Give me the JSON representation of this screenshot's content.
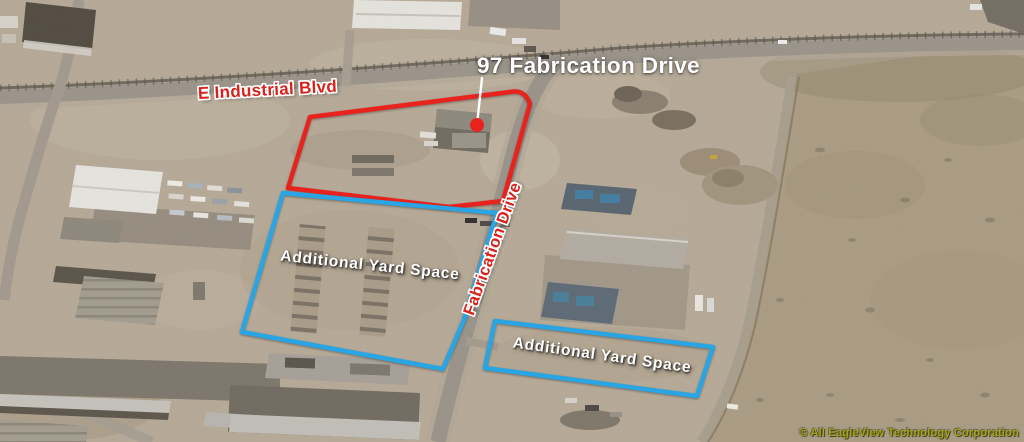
{
  "image": {
    "type": "annotated aerial property map"
  },
  "labels": {
    "property_title": "97 Fabrication Drive",
    "street_horizontal": "E Industrial Blvd",
    "street_diagonal": "Fabrication Drive",
    "yard_left": "Additional Yard Space",
    "yard_right": "Additional Yard Space"
  },
  "footer": {
    "copyright": "© All EagleView Technology Corporation"
  },
  "parcels": [
    {
      "name": "97 Fabrication Drive property",
      "outline": "red"
    },
    {
      "name": "Additional Yard Space (west lot)",
      "outline": "blue"
    },
    {
      "name": "Additional Yard Space (east lot)",
      "outline": "blue"
    }
  ],
  "colors": {
    "primary_parcel_outline": "#e8221c",
    "yard_parcel_outline": "#29a5e3",
    "marker_dot": "#e8221c",
    "street_label_text": "#d8231d",
    "title_text": "#ffffff",
    "yard_label_text": "#ffffff",
    "copyright_text": "#a3a51e"
  }
}
